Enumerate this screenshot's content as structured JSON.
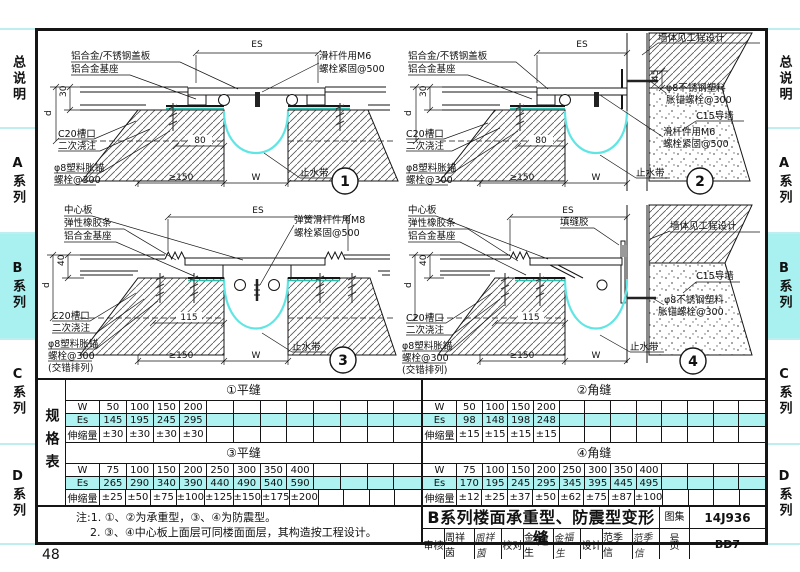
{
  "page_number": "48",
  "colors": {
    "highlight": "#a9f1f1",
    "waterstop_cyan": "#5fe6e4",
    "es_row": "#aef2f2"
  },
  "sidebar": {
    "items": [
      {
        "label": "总说明",
        "active": false
      },
      {
        "label": "A系列",
        "active": false
      },
      {
        "label": "B系列",
        "active": true
      },
      {
        "label": "C系列",
        "active": false
      },
      {
        "label": "D系列",
        "active": false
      }
    ]
  },
  "drawings": {
    "d1": {
      "num": "1",
      "cover": "铝合金/不锈钢盖板",
      "base": "铝合金基座",
      "es": "ES",
      "rod1": "滑杆件用M6",
      "rod2": "螺栓紧固@500",
      "dim_30": "30",
      "dim_d": "d",
      "c20": "C20槽口",
      "pour": "二次浇注",
      "anchor1": "φ8塑料胀锚",
      "anchor2": "螺栓@300",
      "dim_80": "80",
      "dim_150": "≥150",
      "dim_w": "W",
      "waterstop": "止水带"
    },
    "d2": {
      "num": "2",
      "cover": "铝合金/不锈钢盖板",
      "base": "铝合金基座",
      "es": "ES",
      "wall": "墙体见工程设计",
      "dim_45": "45",
      "ss1": "φ8不锈钢塑料",
      "ss2": "胀锚螺栓@300",
      "c15": "C15导墙",
      "rod1": "滑杆件用M6",
      "rod2": "螺栓紧固@500",
      "dim_30": "30",
      "dim_d": "d",
      "c20": "C20槽口",
      "pour": "二次浇注",
      "anchor1": "φ8塑料胀锚",
      "anchor2": "螺栓@300",
      "dim_80": "80",
      "dim_150": "≥150",
      "dim_w": "W",
      "waterstop": "止水带"
    },
    "d3": {
      "num": "3",
      "center": "中心板",
      "rubber": "弹性橡胶条",
      "base": "铝合金基座",
      "es": "ES",
      "spring1": "弹簧滑杆件用M8",
      "spring2": "螺栓紧固@500",
      "dim_40": "40",
      "dim_d": "d",
      "c20": "C20槽口",
      "pour": "二次浇注",
      "anchor1": "φ8塑料胀锚",
      "anchor2": "螺栓@300",
      "stagger": "(交错排列)",
      "dim_115": "115",
      "dim_150": "≥150",
      "dim_w": "W",
      "waterstop": "止水带"
    },
    "d4": {
      "num": "4",
      "center": "中心板",
      "rubber": "弹性橡胶条",
      "base": "铝合金基座",
      "es": "ES",
      "sealant": "填缝胶",
      "wall": "墙体见工程设计",
      "c15": "C15导墙",
      "ss1": "φ8不锈钢塑料",
      "ss2": "胀锚螺栓@300",
      "dim_40": "40",
      "dim_d": "d",
      "c20": "C20槽口",
      "pour": "二次浇注",
      "anchor1": "φ8塑料胀锚",
      "anchor2": "螺栓@300",
      "stagger": "(交错排列)",
      "dim_115": "115",
      "dim_150": "≥150",
      "dim_w": "W",
      "waterstop": "止水带"
    }
  },
  "tables": {
    "side_label": "规格表",
    "row_labels": {
      "w": "W",
      "es": "Es",
      "ext": "伸缩量"
    },
    "t1": {
      "title": "①平缝",
      "w": [
        "50",
        "100",
        "150",
        "200",
        "",
        "",
        "",
        "",
        "",
        "",
        "",
        ""
      ],
      "es": [
        "145",
        "195",
        "245",
        "295",
        "",
        "",
        "",
        "",
        "",
        "",
        "",
        ""
      ],
      "ext": [
        "±30",
        "±30",
        "±30",
        "±30",
        "",
        "",
        "",
        "",
        "",
        "",
        "",
        ""
      ]
    },
    "t2": {
      "title": "②角缝",
      "w": [
        "50",
        "100",
        "150",
        "200",
        "",
        "",
        "",
        "",
        "",
        "",
        "",
        ""
      ],
      "es": [
        "98",
        "148",
        "198",
        "248",
        "",
        "",
        "",
        "",
        "",
        "",
        "",
        ""
      ],
      "ext": [
        "±15",
        "±15",
        "±15",
        "±15",
        "",
        "",
        "",
        "",
        "",
        "",
        "",
        ""
      ]
    },
    "t3": {
      "title": "③平缝",
      "w": [
        "75",
        "100",
        "150",
        "200",
        "250",
        "300",
        "350",
        "400",
        "",
        "",
        "",
        ""
      ],
      "es": [
        "265",
        "290",
        "340",
        "390",
        "440",
        "490",
        "540",
        "590",
        "",
        "",
        "",
        ""
      ],
      "ext": [
        "±25",
        "±50",
        "±75",
        "±100",
        "±125",
        "±150",
        "±175",
        "±200",
        "",
        "",
        "",
        ""
      ]
    },
    "t4": {
      "title": "④角缝",
      "w": [
        "75",
        "100",
        "150",
        "200",
        "250",
        "300",
        "350",
        "400",
        "",
        "",
        "",
        ""
      ],
      "es": [
        "170",
        "195",
        "245",
        "295",
        "345",
        "395",
        "445",
        "495",
        "",
        "",
        "",
        ""
      ],
      "ext": [
        "±12",
        "±25",
        "±37",
        "±50",
        "±62",
        "±75",
        "±87",
        "±100",
        "",
        "",
        "",
        ""
      ]
    }
  },
  "notes": {
    "line1": "注:1. ①、②为承重型，③、④为防震型。",
    "line2": "2. ③、④中心板上面层可同楼面面层，其构造按工程设计。"
  },
  "titleblock": {
    "title": "B系列楼面承重型、防震型变形缝",
    "atlas_label": "图集号",
    "atlas_no": "14J936",
    "page_label": "页",
    "page_no": "BD7",
    "reviewer_label": "审核",
    "reviewer": "周祥茵",
    "reviewer_sig": "周祥茵",
    "checker_label": "校对",
    "checker": "金福生",
    "checker_sig": "金福生",
    "designer_label": "设计",
    "designer": "范季信",
    "designer_sig": "范季信"
  }
}
